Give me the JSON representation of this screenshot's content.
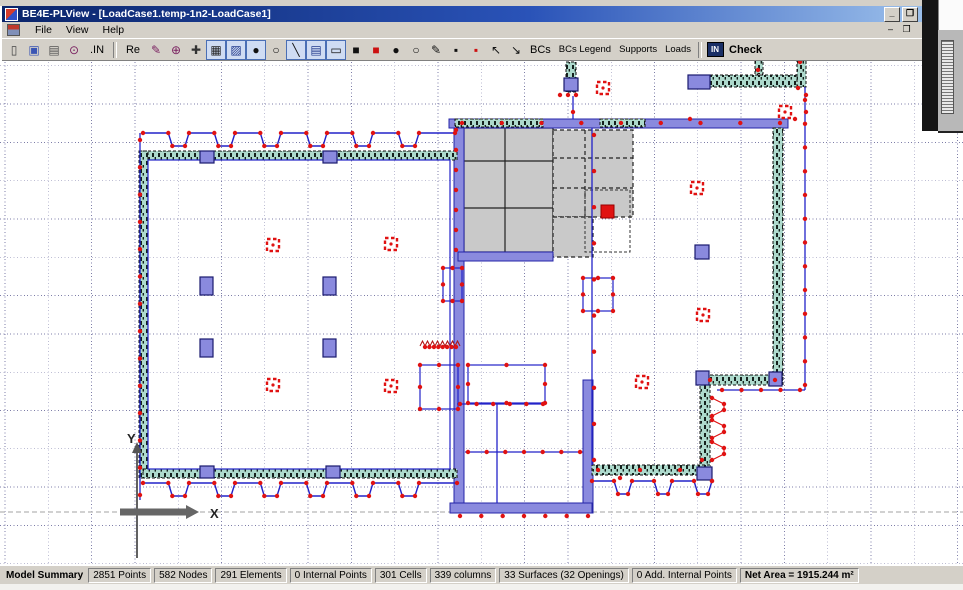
{
  "window": {
    "title": "BE4E-PLView - [LoadCase1.temp-1n2-LoadCase1]",
    "buttons": {
      "minimize": "_",
      "restore": "❐"
    },
    "mdi_buttons": {
      "minimize": "–",
      "restore": "❐"
    }
  },
  "menu": {
    "items": [
      "File",
      "View",
      "Help"
    ]
  },
  "toolbar": {
    "items": [
      {
        "t": "icon",
        "name": "new-file-icon",
        "g": "▯",
        "c": "#444"
      },
      {
        "t": "icon",
        "name": "save-icon",
        "g": "▣",
        "c": "#3a55b4"
      },
      {
        "t": "icon",
        "name": "print-icon",
        "g": "▤",
        "c": "#555"
      },
      {
        "t": "icon",
        "name": "zoom-search-icon",
        "g": "⊙",
        "c": "#7a2060"
      },
      {
        "t": "txt",
        "name": "in-button",
        "label": ".IN"
      },
      {
        "t": "sep"
      },
      {
        "t": "txt",
        "name": "re-button",
        "label": "Re"
      },
      {
        "t": "icon",
        "name": "pointer-edit-icon",
        "g": "✎",
        "c": "#7a2060"
      },
      {
        "t": "icon",
        "name": "zoom-in-icon",
        "g": "⊕",
        "c": "#7a2060"
      },
      {
        "t": "icon",
        "name": "pan-icon",
        "g": "✚",
        "c": "#333"
      },
      {
        "t": "icon",
        "name": "grid-icon",
        "g": "▦",
        "c": "#222",
        "pressed": true
      },
      {
        "t": "icon",
        "name": "snap-grid-icon",
        "g": "▨",
        "c": "#223a8c",
        "pressed": true
      },
      {
        "t": "icon",
        "name": "node-filled-icon",
        "g": "●",
        "c": "#111",
        "pressed": true
      },
      {
        "t": "icon",
        "name": "node-open-icon",
        "g": "○",
        "c": "#111"
      },
      {
        "t": "icon",
        "name": "line-tool-icon",
        "g": "╲",
        "c": "#111",
        "pressed": true
      },
      {
        "t": "icon",
        "name": "keypad-icon",
        "g": "▤",
        "c": "#223a8c",
        "pressed": true
      },
      {
        "t": "icon",
        "name": "rect-tool-icon",
        "g": "▭",
        "c": "#111",
        "pressed": true
      },
      {
        "t": "icon",
        "name": "add-point-black-icon",
        "g": "■",
        "c": "#111"
      },
      {
        "t": "icon",
        "name": "add-point-red-icon",
        "g": "■",
        "c": "#cc1111"
      },
      {
        "t": "icon",
        "name": "move-node-icon",
        "g": "●",
        "c": "#111"
      },
      {
        "t": "icon",
        "name": "move-node-open-icon",
        "g": "○",
        "c": "#111"
      },
      {
        "t": "icon",
        "name": "pen-hash-icon",
        "g": "✎",
        "c": "#111"
      },
      {
        "t": "icon",
        "name": "square-hash-black-icon",
        "g": "▪",
        "c": "#111"
      },
      {
        "t": "icon",
        "name": "square-hash-red-icon",
        "g": "▪",
        "c": "#cc1111"
      },
      {
        "t": "icon",
        "name": "cursor-icon",
        "g": "↖",
        "c": "#111"
      },
      {
        "t": "icon",
        "name": "cursor-line-icon",
        "g": "↘",
        "c": "#111"
      },
      {
        "t": "txt",
        "name": "bcs-button",
        "label": "BCs",
        "bold": false
      },
      {
        "t": "txt",
        "name": "bcs-legend-button",
        "label": "BCs Legend",
        "small": true
      },
      {
        "t": "txt",
        "name": "supports-button",
        "label": "Supports",
        "small": true
      },
      {
        "t": "txt",
        "name": "loads-button",
        "label": "Loads",
        "small": true
      },
      {
        "t": "sep"
      },
      {
        "t": "inbox",
        "name": "in-check-icon",
        "label": "IN"
      },
      {
        "t": "txt",
        "name": "check-button",
        "label": "Check",
        "bold": true
      }
    ]
  },
  "statusbar": {
    "label": "Model Summary",
    "panels": [
      {
        "text": "2851 Points"
      },
      {
        "text": "582 Nodes"
      },
      {
        "text": "291 Elements"
      },
      {
        "text": "0 Internal Points"
      },
      {
        "text": "301 Cells"
      },
      {
        "text": "339 columns"
      },
      {
        "text": "33 Surfaces (32 Openings)"
      },
      {
        "text": "0 Add. Internal Points"
      },
      {
        "text": "Net Area = 1915.244 m²",
        "bold": true
      }
    ]
  },
  "axes": {
    "x_label": "X",
    "y_label": "Y"
  },
  "canvas": {
    "bg": "#ffffff",
    "grid": {
      "x0": 5,
      "dx": 43.3,
      "y0": 65.8,
      "dy": 38.3
    },
    "axis_line_y": 512,
    "colors": {
      "wall_fill": "#aedacd",
      "wall_stroke": "#101010",
      "band": "#8a8ade",
      "band_stroke": "#2424a8",
      "slab": "#c9c9c9",
      "slab_stroke": "#222222",
      "blue": "#2222c8",
      "red": "#e01212",
      "grid": "#7d7da8",
      "axis_gray": "#666666"
    },
    "walls": [
      [
        143,
        151,
        314,
        9
      ],
      [
        139,
        151,
        9,
        327
      ],
      [
        143,
        469,
        314,
        9
      ],
      [
        773,
        128,
        10,
        248
      ],
      [
        700,
        375,
        83,
        10
      ],
      [
        700,
        385,
        10,
        82
      ],
      [
        592,
        465,
        118,
        10
      ],
      [
        710,
        75,
        95,
        12
      ],
      [
        566,
        62,
        10,
        30
      ],
      [
        755,
        60,
        8,
        14
      ],
      [
        797,
        60,
        9,
        27
      ],
      [
        455,
        119,
        88,
        8
      ],
      [
        600,
        119,
        45,
        8
      ]
    ],
    "bands": [
      [
        449,
        119,
        339,
        9
      ],
      [
        454,
        128,
        10,
        385
      ],
      [
        583,
        380,
        10,
        133
      ],
      [
        450,
        503,
        142,
        10
      ],
      [
        458,
        252,
        95,
        9
      ]
    ],
    "slabs": [
      {
        "r": [
          464,
          128,
          89,
          124
        ],
        "v": [
          505
        ],
        "h": [
          161,
          208
        ],
        "dashed": false
      },
      {
        "r": [
          553,
          130,
          80,
          87
        ],
        "v": [
          585
        ],
        "h": [
          158,
          188
        ],
        "dashed": true
      },
      {
        "r": [
          553,
          217,
          40,
          40
        ],
        "v": [],
        "h": [],
        "dashed": true
      }
    ],
    "dashed_boxes": [
      [
        585,
        190,
        45,
        62
      ]
    ],
    "columns": [
      [
        200,
        151,
        14,
        12
      ],
      [
        323,
        151,
        14,
        12
      ],
      [
        200,
        277,
        13,
        18
      ],
      [
        323,
        277,
        13,
        18
      ],
      [
        200,
        339,
        13,
        18
      ],
      [
        323,
        339,
        13,
        18
      ],
      [
        200,
        466,
        14,
        12
      ],
      [
        326,
        466,
        14,
        12
      ],
      [
        688,
        75,
        22,
        14
      ],
      [
        564,
        78,
        14,
        13
      ],
      [
        695,
        245,
        14,
        14
      ],
      [
        696,
        371,
        13,
        14
      ],
      [
        769,
        372,
        13,
        14
      ],
      [
        697,
        467,
        15,
        13
      ]
    ],
    "markers": [
      [
        267,
        239
      ],
      [
        385,
        238
      ],
      [
        267,
        379
      ],
      [
        385,
        380
      ],
      [
        597,
        82
      ],
      [
        779,
        106
      ],
      [
        691,
        182
      ],
      [
        697,
        309
      ],
      [
        636,
        376
      ]
    ],
    "solid_markers": [
      [
        601,
        205,
        13,
        13
      ]
    ],
    "rects": [
      [
        148,
        160,
        302,
        309,
        0
      ],
      [
        443,
        268,
        19,
        33,
        1
      ],
      [
        583,
        278,
        30,
        33,
        1
      ],
      [
        420,
        365,
        38,
        44,
        1
      ],
      [
        468,
        365,
        77,
        38,
        1
      ]
    ],
    "lines": [
      [
        140,
        133,
        140,
        500
      ],
      [
        805,
        87,
        805,
        390
      ],
      [
        717,
        390,
        805,
        390
      ],
      [
        592,
        128,
        592,
        465
      ],
      [
        573,
        96,
        573,
        119
      ],
      [
        497,
        404,
        497,
        503
      ],
      [
        457,
        404,
        545,
        404
      ],
      [
        465,
        452,
        583,
        452
      ]
    ],
    "crenels": [
      [
        143,
        455,
        133,
        146,
        46
      ],
      [
        143,
        457,
        483,
        496,
        46
      ],
      [
        592,
        712,
        481,
        494,
        40
      ]
    ],
    "vcrenel": [
      712,
      398,
      724,
      448
    ],
    "zigzag": [
      420,
      458,
      346,
      5,
      5
    ],
    "dot_lines": [
      [
        140,
        140,
        140,
        495,
        13
      ],
      [
        805,
        100,
        805,
        385,
        12
      ],
      [
        722,
        390,
        800,
        390,
        4
      ],
      [
        460,
        404,
        543,
        404,
        5
      ],
      [
        468,
        452,
        580,
        452,
        6
      ],
      [
        460,
        516,
        588,
        516,
        6
      ],
      [
        456,
        130,
        456,
        250,
        6
      ],
      [
        462,
        123,
        780,
        123,
        8
      ],
      [
        594,
        135,
        594,
        460,
        9
      ],
      [
        425,
        347,
        456,
        347,
        7
      ]
    ],
    "dots": [
      [
        560,
        95
      ],
      [
        568,
        95
      ],
      [
        576,
        95
      ],
      [
        573,
        112
      ],
      [
        798,
        88
      ],
      [
        806,
        95
      ],
      [
        806,
        112
      ],
      [
        795,
        119
      ],
      [
        758,
        70
      ],
      [
        800,
        62
      ],
      [
        690,
        119
      ],
      [
        710,
        380
      ],
      [
        775,
        380
      ],
      [
        702,
        460
      ],
      [
        598,
        470
      ],
      [
        640,
        470
      ],
      [
        680,
        470
      ],
      [
        620,
        478
      ]
    ]
  }
}
